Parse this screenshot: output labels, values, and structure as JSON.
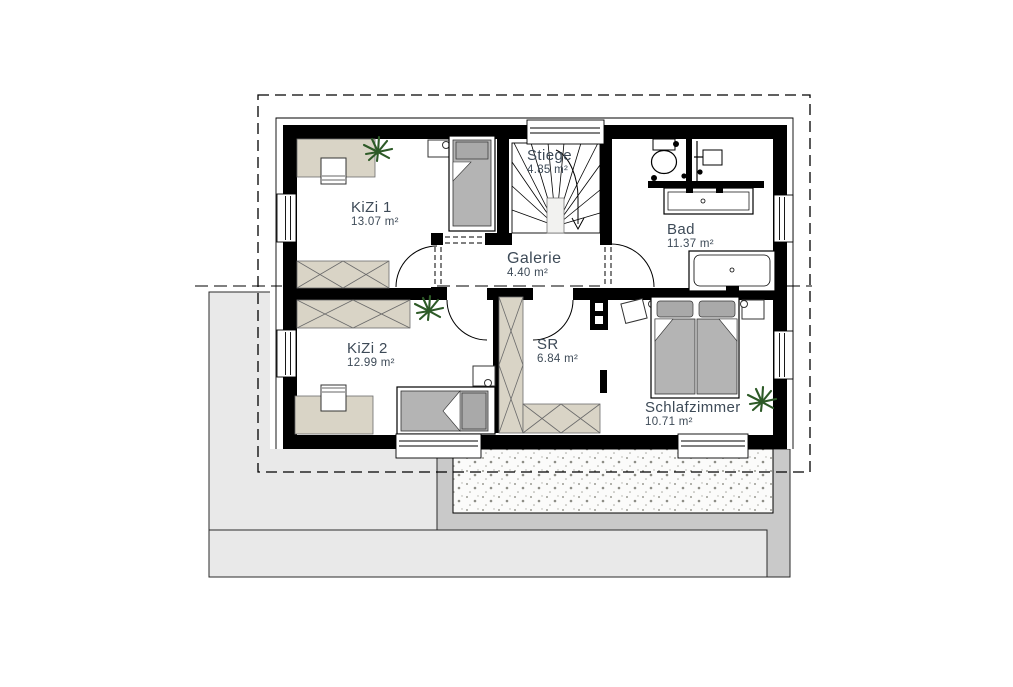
{
  "plan": {
    "title": "Obergeschoss Grundriss",
    "rooms": [
      {
        "id": "kizi1",
        "name": "KiZi 1",
        "area": "13.07 m²"
      },
      {
        "id": "stiege",
        "name": "Stiege",
        "area": "4.85 m²"
      },
      {
        "id": "bad",
        "name": "Bad",
        "area": "11.37 m²"
      },
      {
        "id": "galerie",
        "name": "Galerie",
        "area": "4.40 m²"
      },
      {
        "id": "kizi2",
        "name": "KiZi 2",
        "area": "12.99 m²"
      },
      {
        "id": "sr",
        "name": "SR",
        "area": "6.84 m²"
      },
      {
        "id": "schlafzimmer",
        "name": "Schlafzimmer",
        "area": "10.71 m²"
      }
    ],
    "colors": {
      "wall": "#000000",
      "label_text": "#3d4a57",
      "furniture_beige": "#d9d4c6",
      "mattress_gray": "#b4b4b4",
      "pillow_gray": "#a9a9a9",
      "terrace_light": "#e9e9e9",
      "terrace_mid": "#c9c9c9",
      "gravel_bg": "#fbfbfa",
      "plant_green": "#2d5a27"
    }
  }
}
